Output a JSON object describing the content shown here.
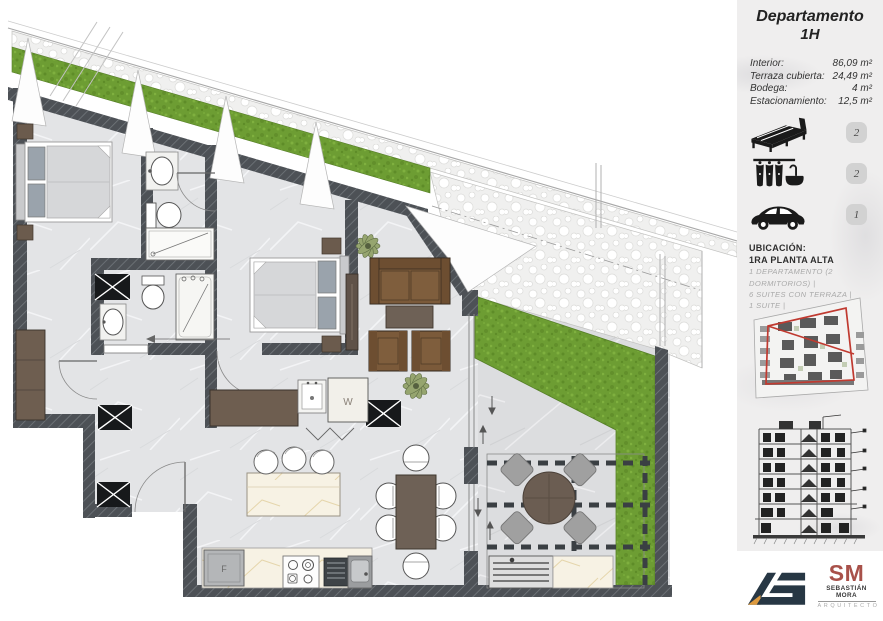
{
  "sidebar": {
    "title_line1": "Departamento",
    "title_line2": "1H",
    "info": [
      {
        "label": "Interior:",
        "value": "86,09 m²"
      },
      {
        "label": "Terraza cubierta:",
        "value": "24,49 m²"
      },
      {
        "label": "Bodega:",
        "value": "4 m²"
      },
      {
        "label": "Estacionamiento:",
        "value": "12,5 m²"
      }
    ],
    "features": [
      {
        "icon": "bed-icon",
        "count": "2"
      },
      {
        "icon": "bath-icon",
        "count": "2"
      },
      {
        "icon": "car-icon",
        "count": "1"
      }
    ],
    "ubicacion": {
      "heading": "UBICACIÓN:",
      "subheading": "1RA PLANTA ALTA",
      "items": [
        "1 DEPARTAMENTO (2 DORMITORIOS) |",
        "6 SUITES CON TERRAZA  |",
        "1 SUITE |"
      ]
    },
    "logos": {
      "sm_initials": "SM",
      "sm_name": "SEBASTIÁN MORA",
      "sm_role": "ARQUITECTO"
    }
  },
  "floorplan": {
    "washer_label": "W",
    "fridge_label": "F"
  },
  "colors": {
    "highlight_red": "#c03a30",
    "grass_green": "#6d9d33",
    "wall_gray": "#4d5156",
    "furniture_wood": "#7b5a3a",
    "sm_logo_red": "#a8514a",
    "ag_logo_navy": "#273744",
    "badge_gray": "#d2d2d2"
  }
}
